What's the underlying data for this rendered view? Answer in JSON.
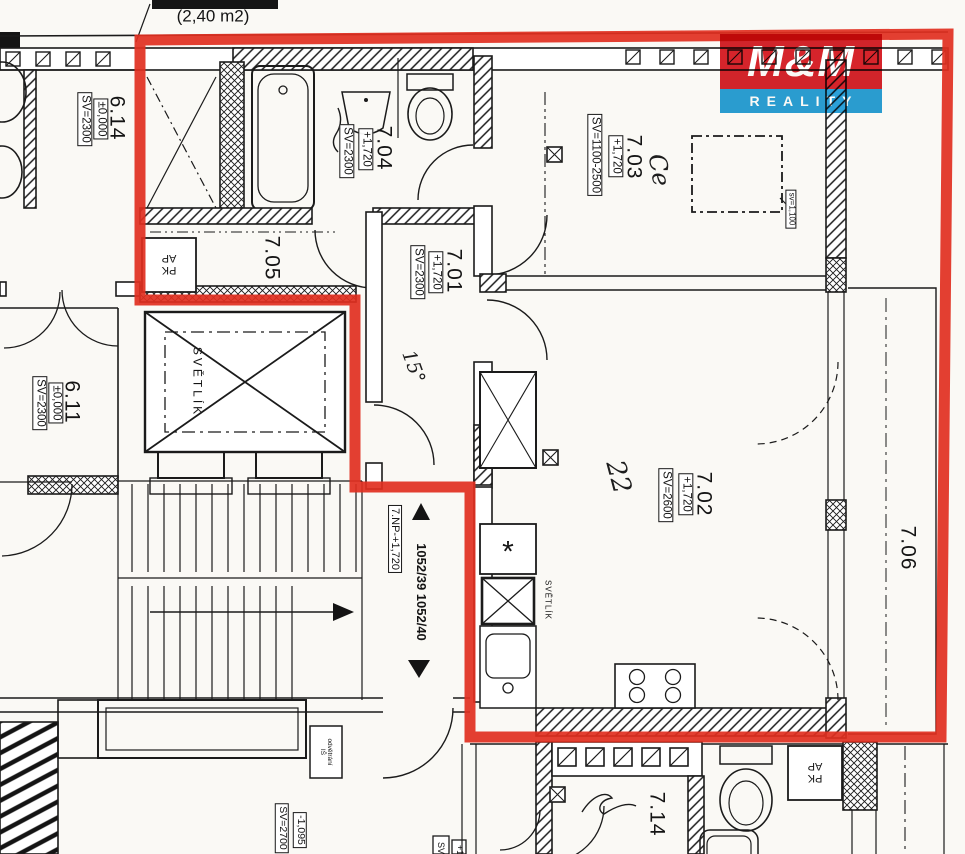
{
  "colors": {
    "outline": "#e12f20",
    "logo_red": "#d6242b",
    "logo_blue": "#2ba0d8",
    "ink": "#1b1b1b",
    "paper": "#faf9f5"
  },
  "logo": {
    "top": "M&M",
    "bottom": "REALITY"
  },
  "notes": {
    "area": "(2,40 m2)"
  },
  "rooms": {
    "r614": {
      "num": "6.14",
      "level": "±0,000",
      "sv": "SV=2300"
    },
    "r611": {
      "num": "6.11",
      "level": "±0,000",
      "sv": "SV=2300"
    },
    "r704": {
      "num": "7.04",
      "level": "+1,720",
      "sv": "SV=2300"
    },
    "r705": {
      "num": "7.05"
    },
    "r701": {
      "num": "7.01",
      "level": "+1,720",
      "sv": "SV=2300"
    },
    "r703": {
      "num": "7.03",
      "level": "+1,720",
      "sv": "SV=1100-2500"
    },
    "r702": {
      "num": "7.02",
      "level": "+1,720",
      "sv": "SV=2600"
    },
    "r706": {
      "num": "7.06"
    },
    "r714": {
      "num": "7.14"
    }
  },
  "labels": {
    "svetlik": "SVĚTLÍK",
    "svetlik_small": "SVĚTLÍK",
    "pk": "PK",
    "ap": "AP",
    "stair_level": "7.NP-+1,720",
    "parcels": "1052/39  1052/40",
    "sv_window": "sv=1,100",
    "level_low": "-1,095",
    "sv_2700": "SV=2700",
    "vent_line1": "odvětrání",
    "vent_line2": "IŠ",
    "clip_sv": "SV",
    "clip_plus": "+1",
    "star": "*"
  },
  "handwriting": {
    "mark_703": "Ce",
    "mark_702": "22",
    "mark_701": "15°"
  }
}
